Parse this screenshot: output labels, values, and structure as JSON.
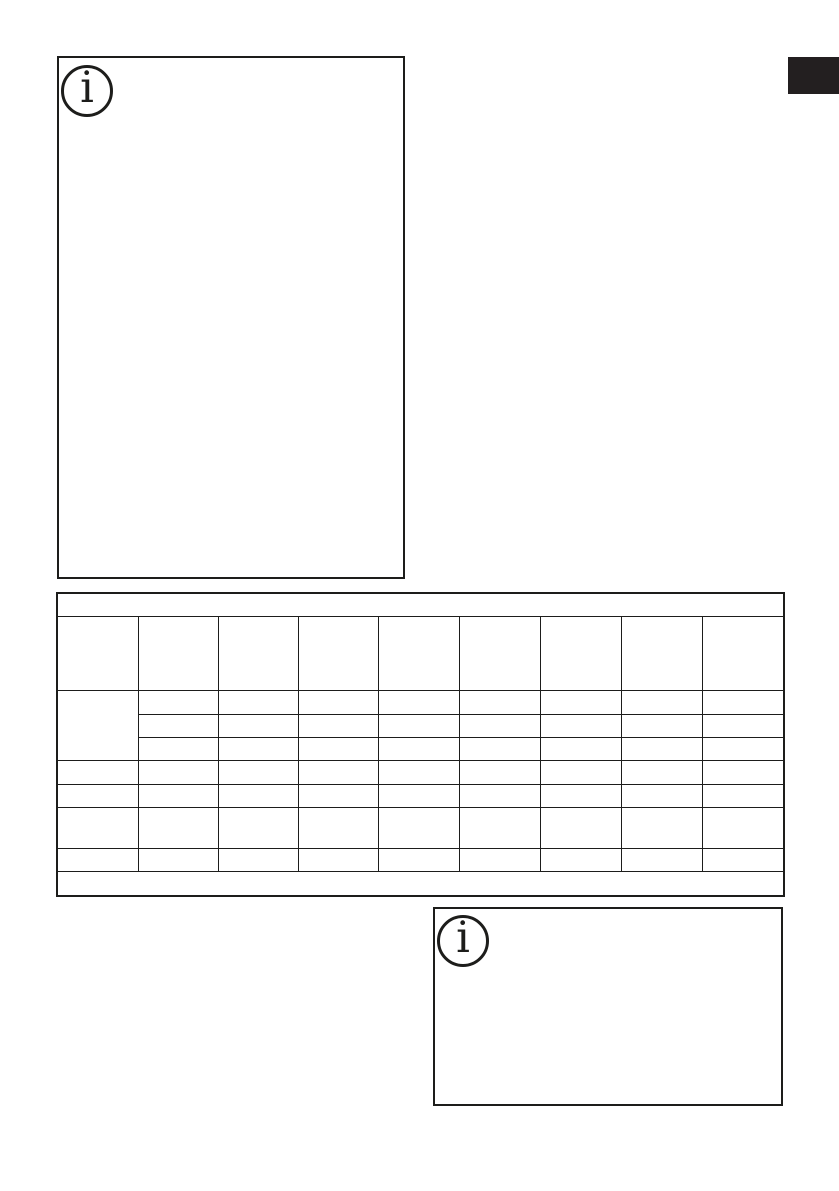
{
  "page": {
    "background": "#ffffff",
    "ink": "#1d1d1b"
  },
  "side_tab": {
    "label": "",
    "color": "#231f20"
  },
  "top_left_info_box": {
    "icon": "info-icon",
    "icon_glyph": "i",
    "content": ""
  },
  "bottom_right_info_box": {
    "icon": "info-icon",
    "icon_glyph": "i",
    "content": ""
  },
  "spec_table": {
    "title": "",
    "column_count": 9,
    "header_cells": [
      "",
      "",
      "",
      "",
      "",
      "",
      "",
      "",
      ""
    ],
    "group": {
      "label": "",
      "sub_rows": [
        [
          "",
          "",
          "",
          "",
          "",
          "",
          "",
          ""
        ],
        [
          "",
          "",
          "",
          "",
          "",
          "",
          "",
          ""
        ],
        [
          "",
          "",
          "",
          "",
          "",
          "",
          "",
          ""
        ]
      ]
    },
    "rows": [
      [
        "",
        "",
        "",
        "",
        "",
        "",
        "",
        "",
        ""
      ],
      [
        "",
        "",
        "",
        "",
        "",
        "",
        "",
        "",
        ""
      ],
      [
        "",
        "",
        "",
        "",
        "",
        "",
        "",
        "",
        ""
      ],
      [
        "",
        "",
        "",
        "",
        "",
        "",
        "",
        "",
        ""
      ]
    ],
    "footnote": ""
  }
}
